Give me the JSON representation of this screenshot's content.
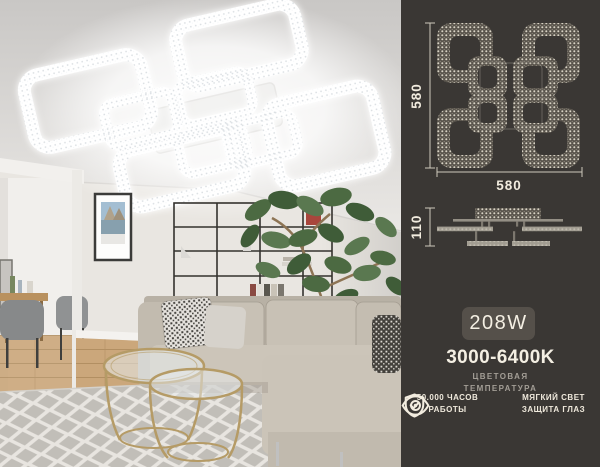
{
  "spec_panel": {
    "bg": "#3a3734",
    "text_color": "#f4efe3",
    "muted_color": "#a39e96",
    "line_color": "#cdc8bb",
    "top_view": {
      "width_label": "580",
      "height_label": "580"
    },
    "side_view": {
      "height_label": "110"
    },
    "power": {
      "label": "208W",
      "badge_bg": "#55504a"
    },
    "color_temperature": {
      "value": "3000-6400K",
      "caption_line1": "ЦВЕТОВАЯ",
      "caption_line2": "ТЕМПЕРАТУРА"
    },
    "features": [
      {
        "icon": "shield-check-icon",
        "line1": "50.000 ЧАСОВ",
        "line2": "РАБОТЫ"
      },
      {
        "icon": "eye-icon",
        "line1": "МЯГКИЙ СВЕТ",
        "line2": "ЗАЩИТА ГЛАЗ"
      }
    ]
  },
  "photo_colors": {
    "ceiling": "#dddbd8",
    "wall": "#e9e6e1",
    "sofa": "#c6bfb3",
    "rug_base": "#e8e5e0",
    "rug_pattern": "#b7b4ae",
    "floor_wood": "#cba77b",
    "plant_green": "#4a673f",
    "table_gold": "#b59b66",
    "light_glow": "#ffffff"
  }
}
